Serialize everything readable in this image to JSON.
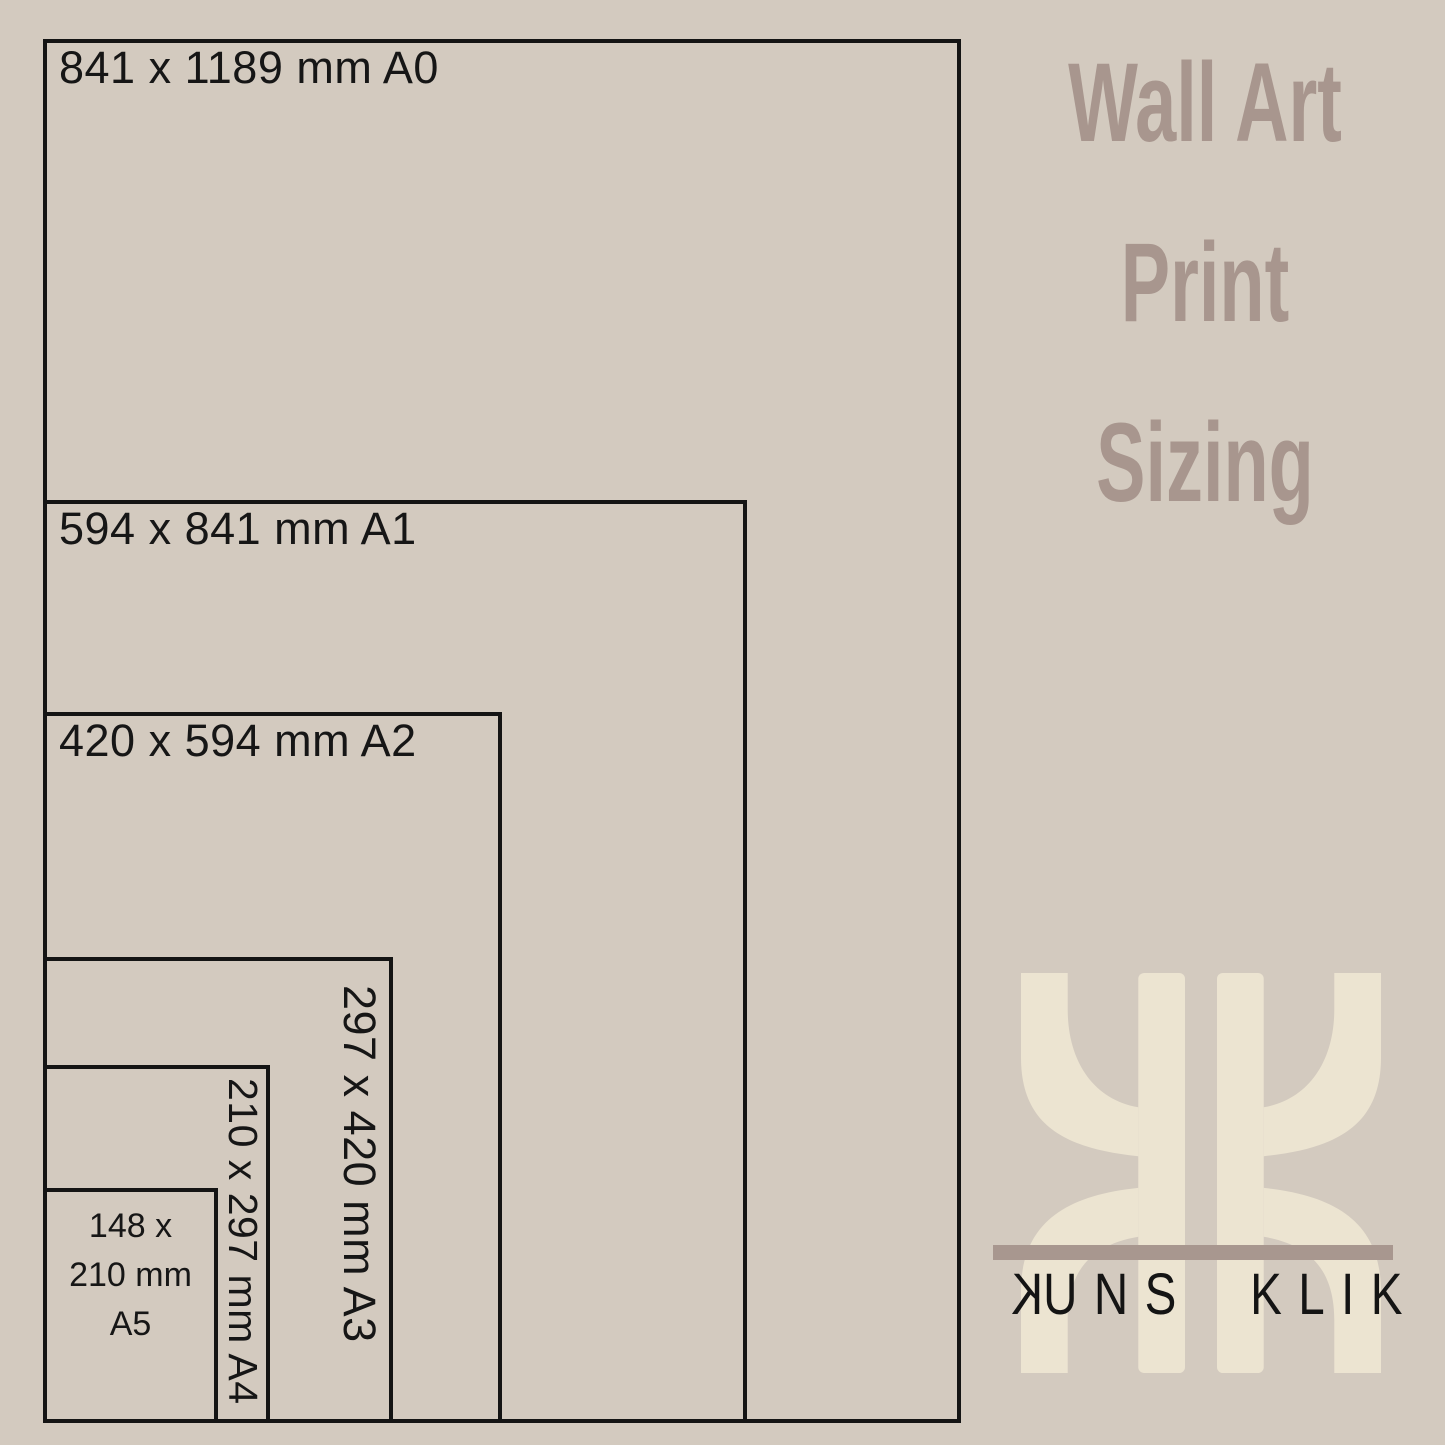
{
  "heading": {
    "lines": [
      "Wall Art",
      "Print",
      "Sizing"
    ]
  },
  "sizes": {
    "a0": {
      "label": "841 x 1189 mm A0"
    },
    "a1": {
      "label": "594 x 841 mm A1"
    },
    "a2": {
      "label": "420 x 594 mm A2"
    },
    "a3": {
      "label": "297 x 420 mm A3"
    },
    "a4": {
      "label": "210 x 297 mm A4"
    },
    "a5": {
      "lines": [
        "148 x",
        "210 mm",
        "A5"
      ]
    }
  },
  "logo": {
    "monogram": "KK",
    "word_left_initial": "K",
    "word_left_rest": "UNS",
    "word_right": "KLIK"
  },
  "colors": {
    "background": "#d3cabf",
    "line": "#141414",
    "heading_text": "#a8968e",
    "monogram_cream": "#ece4d1",
    "divider_bar": "#a8978f",
    "wordmark_text": "#141414"
  }
}
